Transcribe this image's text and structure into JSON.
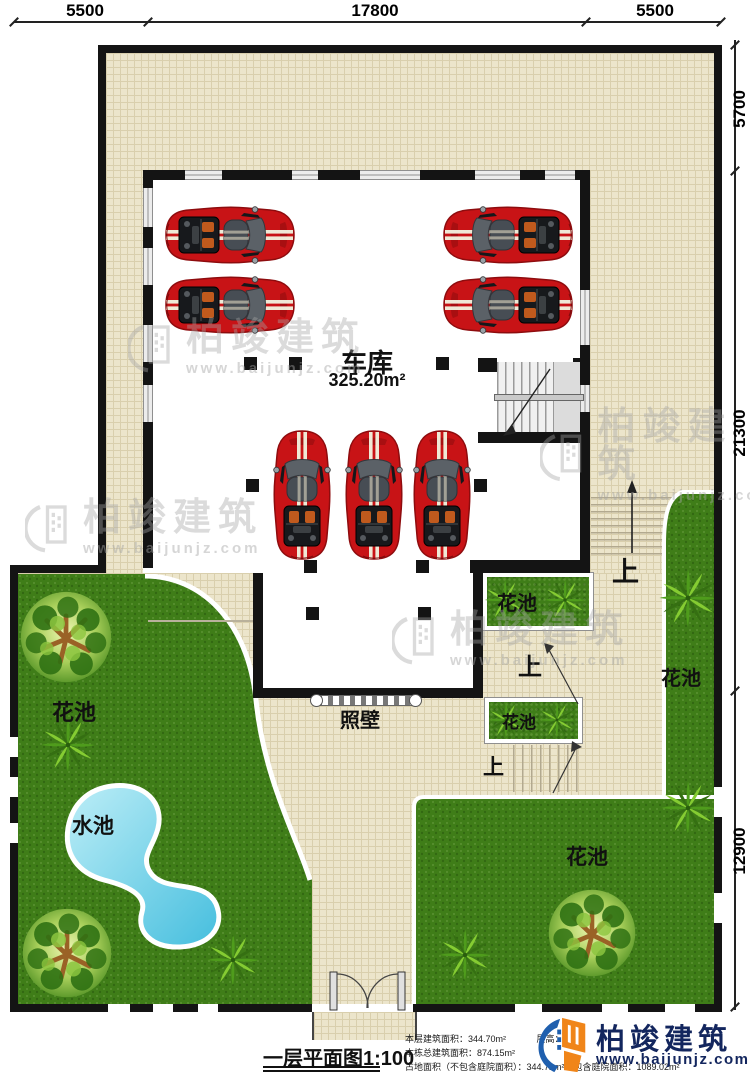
{
  "dims": {
    "top": [
      "5500",
      "17800",
      "5500"
    ],
    "right": [
      "5700",
      "21300",
      "12900"
    ]
  },
  "garage": {
    "name": "车库",
    "area": "325.20m²"
  },
  "labels": {
    "flower_bed": "花池",
    "water_pool": "水池",
    "screen_wall": "照壁",
    "up": "上"
  },
  "watermark": {
    "brand": "柏竣建筑",
    "url": "www.baijunjz.com"
  },
  "logo": {
    "brand": "柏竣建筑",
    "url": "www.baijunjz.com"
  },
  "title": {
    "text": "一层平面图1:100"
  },
  "info": {
    "floor_area": "本层建筑面积：344.70m²",
    "floor_height": "层高：3.3m",
    "total_area": "本栋总建筑面积：874.15m²",
    "footprint": "占地面积（不包含庭院面积）：344.72m²（包含庭院面积：1089.02m²"
  },
  "colors": {
    "wall": "#141414",
    "tile": "#ece5cb",
    "lawn": "#3f7d18",
    "pool": "#45bede",
    "car_red": "#c81316",
    "logo_blue": "#1f5fae",
    "logo_orange": "#f08519"
  }
}
